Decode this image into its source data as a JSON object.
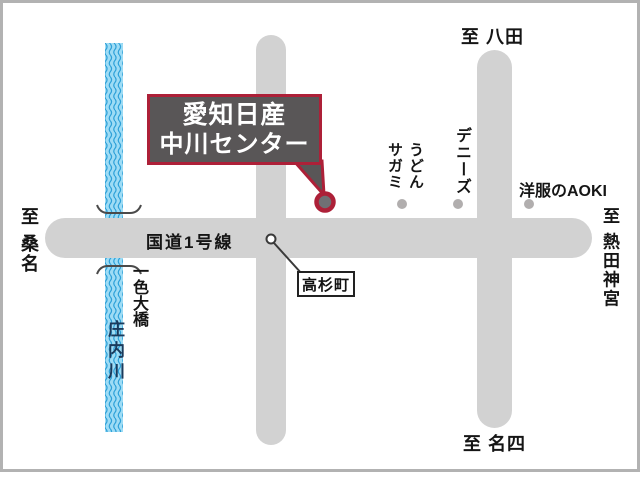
{
  "map": {
    "dealer": {
      "name_line1": "愛知日産",
      "name_line2": "中川センター"
    },
    "road_label": "国道1号線",
    "directions": {
      "top": "至 八田",
      "left": "至 桑名",
      "right": "至 熱田神宮",
      "bottom": "至 名四"
    },
    "landmarks": {
      "intersection": "高杉町",
      "udon_line1": "うどん",
      "udon_line2": "サガミ",
      "dennys": "デニーズ",
      "aoki": "洋服のAOKI"
    },
    "river": {
      "name": "庄内川",
      "bridge": "一色大橋"
    },
    "colors": {
      "accent_red": "#ad2038",
      "road_gray": "#d2d2d2",
      "box_gray": "#595657",
      "river_blue": "#9edcf5",
      "wave_blue": "#2da0d8",
      "dot_gray": "#b1aeae"
    }
  }
}
